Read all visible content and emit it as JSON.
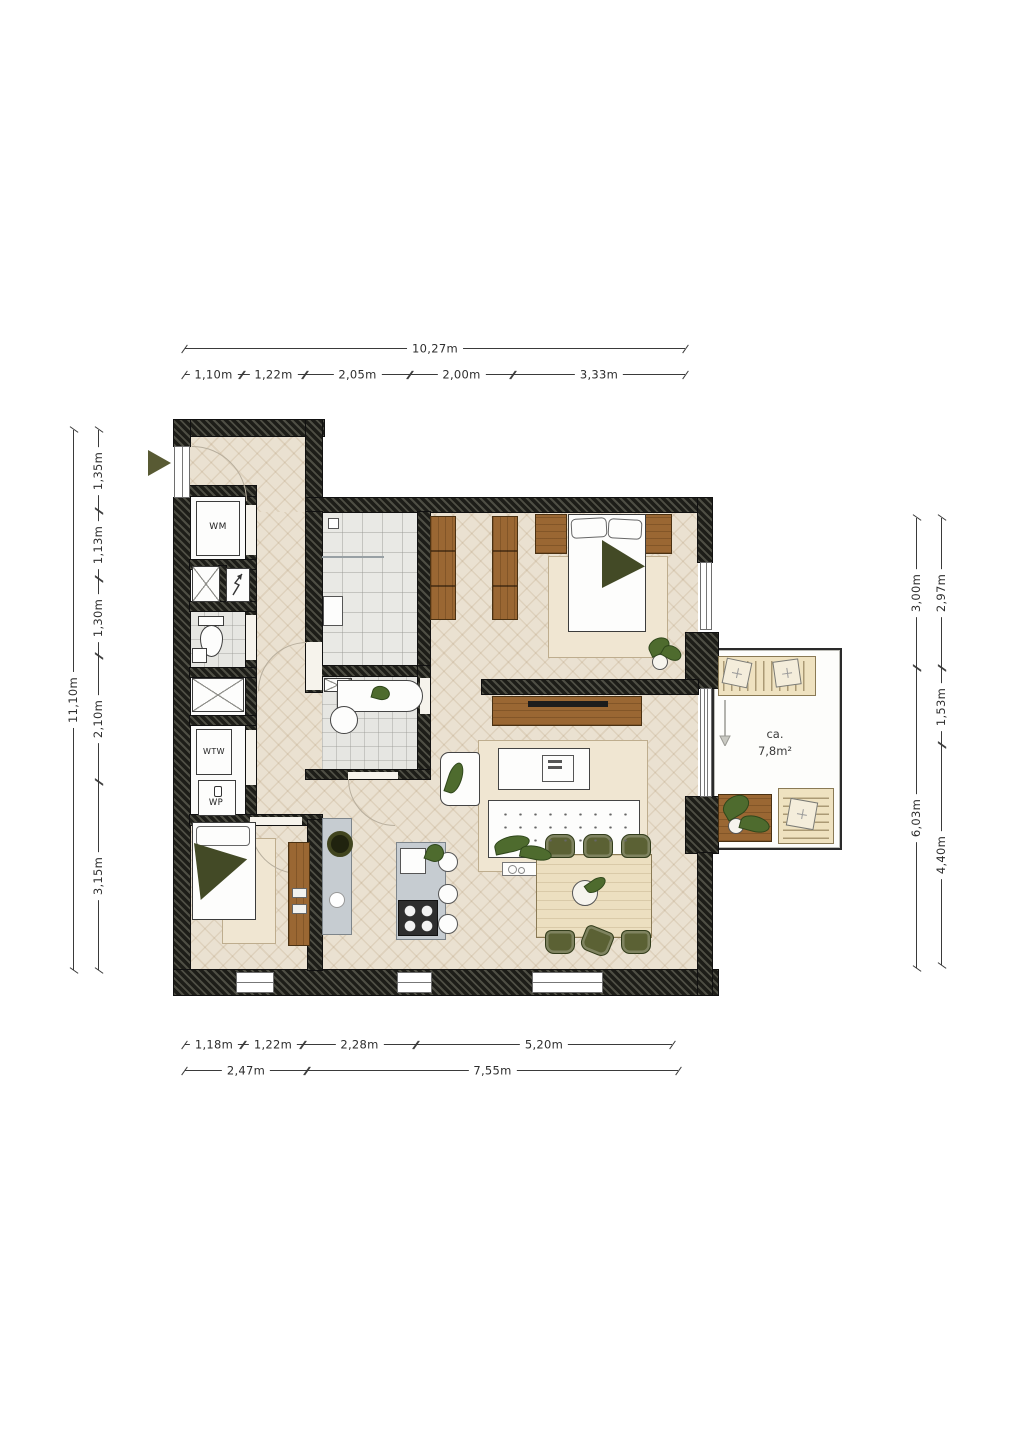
{
  "labels": {
    "washing_machine": "WM",
    "heat_recovery_unit": "WTW",
    "heat_pump": "WP",
    "balcony_area_prefix": "ca.",
    "balcony_area_value": "7,8m²"
  },
  "dimensions": {
    "top": {
      "overall": "10,27m",
      "segments": [
        "1,10m",
        "1,22m",
        "2,05m",
        "2,00m",
        "3,33m"
      ]
    },
    "left": {
      "overall": "11,10m",
      "segments": [
        "1,35m",
        "1,13m",
        "1,30m",
        "2,10m",
        "3,15m"
      ]
    },
    "right": {
      "outer": [
        "3,00m",
        "6,03m"
      ],
      "inner": [
        "2,97m",
        "1,53m",
        "4,40m"
      ]
    },
    "bottom": {
      "upper": [
        "1,18m",
        "1,22m",
        "2,28m",
        "5,20m"
      ],
      "lower": [
        "2,47m",
        "7,55m"
      ]
    }
  },
  "icons": {
    "entrance_arrow": "triangle-right",
    "meter_cabinet_arrow": "zigzag-arrow",
    "balcony_exit_arrow": "arrow-down"
  },
  "colors": {
    "wall": "#1d1d18",
    "wall_hatch": "#4e4e44",
    "floor_wood": "#eae1d1",
    "tile": "#e9e9e5",
    "wood_furniture": "#9a6733",
    "olive_accent": "#5b6134",
    "kitchen_gray": "#c6ccd1",
    "rug": "#f0e6d2",
    "dim_text": "#2e2e2e"
  }
}
